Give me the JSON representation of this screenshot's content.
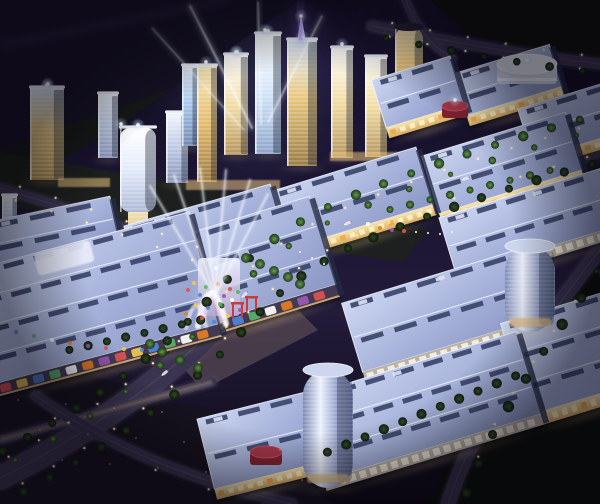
{
  "image": {
    "title": "Aerial night rendering of a mixed-use trade-city masterplan",
    "type": "architectural-rendering",
    "time_of_day": "night",
    "view": "aerial-oblique",
    "contents": "Cluster of illuminated glass skyscrapers with searchlight beams, rows of large exhibition-hall buildings with periwinkle roofs and warm lit facades, tree-lined boulevards, plazas, cylindrical towers, parking lots"
  },
  "palette": {
    "sky_top": "#0a0816",
    "sky_upper": "#191430",
    "sky_mid": "#221b3a",
    "sky_bottom": "#0d0a16",
    "purple_glow": "#7a58cc",
    "cyan_glow": "#9fd0f0",
    "beam_purple": "#b388ff",
    "beam_white": "#eef6ff",
    "roof_light": "#ced7f2",
    "roof_mid": "#a6b2da",
    "roof_dark": "#8b97c4",
    "roof_ridge": "#eef2fc",
    "skylight": "#384268",
    "facade_warm_hi": "#f8e6b2",
    "facade_warm_lo": "#d8ae64",
    "window_warm": "#fff0c0",
    "window_orange": "#f0a850",
    "glass_white": "#ffffff",
    "glass_pale": "#bcc8e4",
    "glass_blue": "#a4c4ea",
    "glass_gold": "#e3ba6c",
    "tower_cap": "#f6faff",
    "road": "#3a3450",
    "road_edge": "#564e70",
    "road_warm": "#b09a6e",
    "tree_dark": "#2e4a22",
    "tree_lit": "#5f9a44",
    "lawn": "#1c2415",
    "terrain_dark": "#161226",
    "terrain_green": "#0f120c",
    "plaza": "#50424e",
    "drum_red": "#a23648",
    "drum_red_dark": "#7e2230",
    "poster_panel": "#f6eedd",
    "poster_bg": "#b9b2a6",
    "colorful_bg": "#433a52",
    "glow_warm": "#ffdf9e",
    "accents": [
      "#e05252",
      "#f2c94c",
      "#4f86d9",
      "#58b368",
      "#ffffff",
      "#e67e22",
      "#9b59b6"
    ]
  },
  "scene": {
    "sky_glows": [
      {
        "name": "purple-sky-glow",
        "cx": 300,
        "cy": 34,
        "r": 170,
        "kind": "purple",
        "op": 0.28
      },
      {
        "name": "purple-sky-glow-2",
        "cx": 425,
        "cy": 10,
        "r": 95,
        "kind": "purple",
        "op": 0.18
      },
      {
        "name": "cyan-cluster-glow",
        "cx": 248,
        "cy": 86,
        "r": 110,
        "kind": "cyan",
        "op": 0.22
      },
      {
        "name": "spire-halo",
        "cx": 300,
        "cy": 60,
        "r": 70,
        "kind": "purple",
        "op": 0.22
      }
    ],
    "terrain": [
      {
        "name": "terrain-northwest",
        "pts": "0,0 300,0 172,88 0,150",
        "fill": "#161226",
        "op": 1
      },
      {
        "name": "terrain-northwest-hill",
        "pts": "0,150 172,88 120,126 0,196",
        "fill": "#161b13",
        "op": 0.8
      },
      {
        "name": "terrain-northeast",
        "pts": "430,0 600,0 600,72 468,34",
        "fill": "#0f120c",
        "op": 1
      },
      {
        "name": "lawn-tower-belt",
        "pts": "0,152 430,228 402,262 0,206",
        "fill": "#1c2415",
        "op": 0.7
      },
      {
        "name": "terrain-southeast",
        "pts": "522,322 600,262 600,504 428,504",
        "fill": "#0c0f0a",
        "op": 1
      },
      {
        "name": "parking-southwest",
        "pts": "0,348 238,418 332,504 0,504",
        "fill": "#16121f",
        "op": 1
      },
      {
        "name": "plaza-gate",
        "pts": "152,330 276,288 318,330 202,390",
        "fill": "#50424e",
        "op": 0.85
      }
    ],
    "roads": [
      {
        "name": "road-main",
        "d": "M 600,138 C 520,160 440,185 360,218 C 310,238 268,268 230,310 C 182,368 92,432 0,478",
        "width": 24
      },
      {
        "name": "road-north",
        "d": "M 372,26 C 450,42 530,56 600,64",
        "width": 11
      },
      {
        "name": "road-north-branch",
        "d": "M 406,0 C 414,22 428,44 452,58",
        "width": 9
      },
      {
        "name": "road-east",
        "d": "M 600,250 C 560,300 520,360 490,410 C 472,442 458,472 448,504",
        "width": 15
      },
      {
        "name": "road-west",
        "d": "M 0,188 C 80,212 150,236 212,260",
        "width": 10
      },
      {
        "name": "road-southwest",
        "d": "M 212,382 L 0,440",
        "width": 9,
        "tone": "warm"
      },
      {
        "name": "road-south",
        "d": "M 36,396 C 110,448 190,480 292,504",
        "width": 11
      }
    ],
    "street_lights": [
      {
        "road": "road-main",
        "n": 20,
        "offset": 15,
        "both": true
      },
      {
        "road": "road-north",
        "n": 6,
        "offset": 7,
        "both": true
      },
      {
        "road": "road-east",
        "n": 8,
        "offset": -11,
        "both": false
      },
      {
        "road": "road-west",
        "n": 6,
        "offset": 7,
        "both": true
      },
      {
        "road": "road-south",
        "n": 5,
        "offset": 8,
        "both": false
      }
    ],
    "tree_rows": [
      {
        "road": "road-main",
        "n": 24,
        "offset": 23,
        "both": true,
        "r": 4
      },
      {
        "road": "road-main",
        "n": 16,
        "offset": 9,
        "both": false,
        "r": 2.6,
        "lit": true
      },
      {
        "road": "road-east",
        "n": 9,
        "offset": -14,
        "both": false,
        "r": 4.5
      },
      {
        "road": "road-north",
        "n": 7,
        "offset": 9,
        "both": false,
        "r": 3.2
      }
    ],
    "tree_lines": [
      {
        "x1": 318,
        "y1": 456,
        "x2": 525,
        "y2": 372,
        "n": 11,
        "r": 4.5,
        "lit": false
      },
      {
        "x1": 60,
        "y1": 352,
        "x2": 210,
        "y2": 318,
        "n": 8,
        "r": 4,
        "lit": false
      },
      {
        "x1": 380,
        "y1": 212,
        "x2": 560,
        "y2": 168,
        "n": 9,
        "r": 3.5,
        "lit": true
      }
    ],
    "tree_clusters": [
      [
        246,
        258
      ],
      [
        260,
        264
      ],
      [
        274,
        271
      ],
      [
        288,
        277
      ],
      [
        300,
        284
      ],
      [
        162,
        352
      ],
      [
        180,
        360
      ],
      [
        198,
        368
      ],
      [
        150,
        344
      ]
    ],
    "cars": [
      {
        "t": 0.2
      },
      {
        "t": 0.38
      },
      {
        "t": 0.56
      },
      {
        "t": 0.72
      }
    ],
    "towers": [
      {
        "name": "tower-left-edge",
        "x": 2,
        "y": 196,
        "w": 15,
        "h": 46,
        "style": "pale"
      },
      {
        "name": "tower-west-a",
        "x": 30,
        "y": 88,
        "w": 34,
        "h": 92,
        "style": "amberblue",
        "flare": true
      },
      {
        "name": "tower-west-b",
        "x": 98,
        "y": 94,
        "w": 20,
        "h": 64,
        "style": "pale"
      },
      {
        "name": "tower-wave",
        "x": 120,
        "y": 128,
        "w": 36,
        "h": 84,
        "style": "whitecurve",
        "rx": 10,
        "flare": true
      },
      {
        "name": "tower-mid-a",
        "x": 166,
        "y": 113,
        "w": 22,
        "h": 70,
        "style": "pale"
      },
      {
        "name": "tower-mid-b",
        "x": 182,
        "y": 66,
        "w": 15,
        "h": 80,
        "style": "blue"
      },
      {
        "name": "tower-gold-a",
        "x": 197,
        "y": 66,
        "w": 20,
        "h": 116,
        "style": "gold"
      },
      {
        "name": "tower-gold-b",
        "x": 224,
        "y": 55,
        "w": 24,
        "h": 100,
        "style": "goldwhite",
        "flare": true
      },
      {
        "name": "tower-blue-tall",
        "x": 255,
        "y": 34,
        "w": 26,
        "h": 120,
        "style": "bluewhite",
        "flare": true
      },
      {
        "name": "tower-spire",
        "x": 287,
        "y": 40,
        "w": 30,
        "h": 126,
        "style": "amberblue",
        "spire": true,
        "flare": true
      },
      {
        "name": "tower-east-a",
        "x": 331,
        "y": 48,
        "w": 22,
        "h": 110,
        "style": "goldwhite"
      },
      {
        "name": "tower-east-b",
        "x": 365,
        "y": 57,
        "w": 22,
        "h": 100,
        "style": "goldwhite"
      },
      {
        "name": "tower-gold-cylinder",
        "x": 395,
        "y": 26,
        "w": 28,
        "h": 90,
        "style": "goldcyl",
        "rx": 13
      }
    ],
    "podiums": [
      {
        "x": 186,
        "y": 180,
        "w": 94,
        "h": 10
      },
      {
        "x": 330,
        "y": 152,
        "w": 74,
        "h": 9
      },
      {
        "x": 58,
        "y": 178,
        "w": 52,
        "h": 9
      }
    ],
    "gold_end_wall": {
      "x": 128,
      "y": 212,
      "w": 20,
      "h": 92
    },
    "halls": [
      {
        "name": "hall-northeast-b",
        "cx": 508,
        "cy": 80,
        "w": 100,
        "h": 44,
        "rot": -17,
        "facade": "warm"
      },
      {
        "name": "hall-northeast-a",
        "cx": 418,
        "cy": 92,
        "w": 82,
        "h": 50,
        "rot": -17,
        "facade": "warm"
      },
      {
        "name": "hall-northeast-c",
        "cx": 578,
        "cy": 118,
        "w": 110,
        "h": 52,
        "rot": -17,
        "facade": "warm"
      },
      {
        "name": "hall-mid-row-c",
        "cx": 502,
        "cy": 163,
        "w": 150,
        "h": 60,
        "rot": -17,
        "facade": "warm"
      },
      {
        "name": "hall-mid-row-b",
        "cx": 352,
        "cy": 198,
        "w": 152,
        "h": 60,
        "rot": -17,
        "facade": "warm"
      },
      {
        "name": "hall-south-row-a",
        "cx": 528,
        "cy": 222,
        "w": 168,
        "h": 60,
        "rot": -17,
        "facade": "poster"
      },
      {
        "name": "hall-west-edge",
        "cx": 52,
        "cy": 232,
        "w": 128,
        "h": 46,
        "rot": -12,
        "facade": "warm"
      },
      {
        "name": "hall-mid-row-a",
        "cx": 205,
        "cy": 233,
        "w": 152,
        "h": 58,
        "rot": -16,
        "facade": "warm"
      },
      {
        "name": "hall-west-block-b",
        "cx": 252,
        "cy": 262,
        "w": 148,
        "h": 92,
        "rot": -17,
        "facade": "colorful"
      },
      {
        "name": "hall-west-block-a",
        "cx": 92,
        "cy": 298,
        "w": 232,
        "h": 116,
        "rot": -15,
        "facade": "colorful"
      },
      {
        "name": "hall-south-row-b",
        "cx": 443,
        "cy": 310,
        "w": 190,
        "h": 72,
        "rot": -17,
        "facade": "poster"
      },
      {
        "name": "hall-south-east",
        "cx": 572,
        "cy": 352,
        "w": 120,
        "h": 96,
        "rot": -17,
        "facade": "warm"
      },
      {
        "name": "hall-south-row-c",
        "cx": 420,
        "cy": 406,
        "w": 228,
        "h": 86,
        "rot": -17,
        "facade": "poster"
      },
      {
        "name": "hall-south-center",
        "cx": 262,
        "cy": 440,
        "w": 116,
        "h": 72,
        "rot": -14,
        "facade": "warm"
      }
    ],
    "atrium_skylight": {
      "cx": 64,
      "cy": 258,
      "w": 58,
      "h": 22,
      "rot": -15
    },
    "cylinders": [
      {
        "name": "tower-cylinder-south",
        "x": 303,
        "y": 362,
        "w": 50,
        "h": 126
      },
      {
        "name": "tower-cylinder-east",
        "x": 505,
        "y": 238,
        "w": 50,
        "h": 94
      }
    ],
    "drums": [
      {
        "name": "drum-white",
        "cx": 527,
        "cy": 64,
        "rx": 30,
        "ry": 10,
        "h": 20,
        "fill": "white"
      },
      {
        "name": "drum-red-a",
        "cx": 455,
        "cy": 106,
        "rx": 13,
        "ry": 5,
        "h": 12,
        "fill": "red"
      },
      {
        "name": "drum-red-b",
        "cx": 266,
        "cy": 452,
        "rx": 16,
        "ry": 6,
        "h": 13,
        "fill": "red"
      }
    ],
    "gate": {
      "glow": [
        214,
        296,
        26
      ],
      "wall": {
        "x": 198,
        "y": 258,
        "w": 42,
        "h": 58
      },
      "arcs": [
        {
          "d": "M 198,326 Q 210,262 226,324",
          "w": 6,
          "color": "#ffffff",
          "op": 0.85
        },
        {
          "d": "M 203,324 Q 212,274 221,322",
          "w": 3,
          "color": "#f8d8ec",
          "op": 0.8
        },
        {
          "d": "M 186,328 Q 196,284 206,326",
          "w": 4,
          "color": "#e8eaf8",
          "op": 0.7
        }
      ],
      "poles": [
        [
          232,
          304
        ],
        [
          246,
          298
        ]
      ]
    },
    "beams": {
      "purple_core": "296,0 305,0 302,40 299,40",
      "purple_soft": "286,0 316,0 303,46 297,46",
      "white": [
        [
          252,
          128,
          190,
          6,
          5
        ],
        [
          261,
          124,
          258,
          2,
          4
        ],
        [
          268,
          122,
          322,
          16,
          4
        ],
        [
          244,
          130,
          152,
          28,
          3
        ]
      ],
      "gate_origin": [
        215,
        296
      ],
      "gate_ends": [
        [
          150,
          186
        ],
        [
          174,
          175
        ],
        [
          200,
          168
        ],
        [
          226,
          170
        ],
        [
          250,
          180
        ],
        [
          268,
          194
        ]
      ]
    },
    "flares": [
      [
        237,
        52
      ],
      [
        265,
        30
      ],
      [
        301,
        16
      ],
      [
        206,
        62
      ],
      [
        342,
        44
      ],
      [
        121,
        124
      ],
      [
        48,
        84
      ],
      [
        527,
        60
      ],
      [
        216,
        268
      ],
      [
        455,
        100
      ]
    ],
    "balloons": [
      [
        188,
        290
      ],
      [
        194,
        283
      ],
      [
        200,
        295
      ],
      [
        206,
        287
      ],
      [
        212,
        292
      ],
      [
        218,
        284
      ],
      [
        224,
        296
      ],
      [
        230,
        289
      ],
      [
        196,
        305
      ],
      [
        208,
        308
      ],
      [
        220,
        304
      ],
      [
        232,
        300
      ],
      [
        186,
        314
      ],
      [
        240,
        310
      ],
      [
        202,
        318
      ],
      [
        228,
        316
      ],
      [
        214,
        322
      ],
      [
        238,
        292
      ],
      [
        368,
        224
      ],
      [
        380,
        228
      ],
      [
        392,
        230
      ],
      [
        404,
        231
      ]
    ],
    "facade_dots": [
      [
        16,
        332
      ],
      [
        34,
        336
      ],
      [
        52,
        340
      ],
      [
        70,
        343
      ],
      [
        88,
        346
      ],
      [
        106,
        348
      ],
      [
        124,
        349
      ],
      [
        142,
        350
      ]
    ],
    "people_dots": [
      [
        416,
        232
      ],
      [
        428,
        233
      ],
      [
        440,
        234
      ],
      [
        452,
        232
      ],
      [
        300,
        252
      ],
      [
        312,
        258
      ],
      [
        324,
        264
      ]
    ],
    "parking_lights": {
      "cols": 6,
      "rows": 3,
      "x0": 18,
      "y0": 400,
      "dx": 48,
      "dy": 30,
      "skx": 22,
      "sky": 4
    }
  }
}
